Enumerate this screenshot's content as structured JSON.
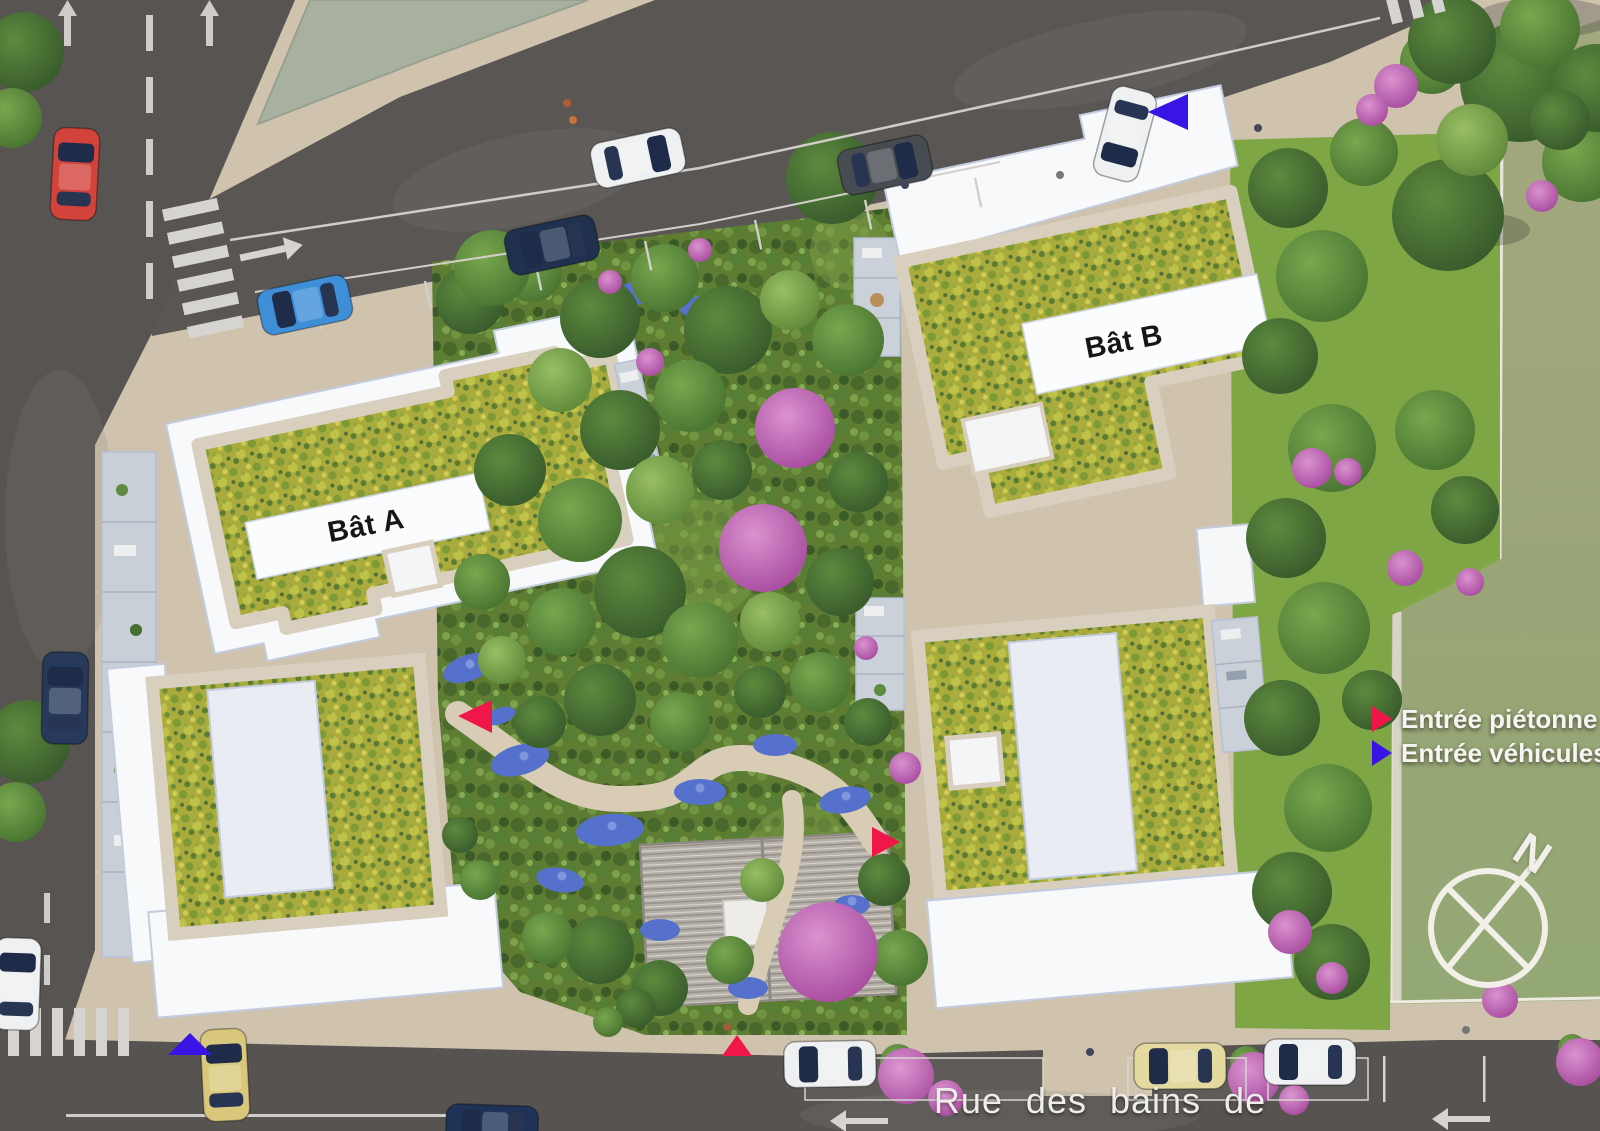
{
  "scene": {
    "type": "aerial-residential-site-plan"
  },
  "buildings": {
    "a": {
      "label": "Bât A"
    },
    "b": {
      "label": "Bât B"
    }
  },
  "legend": {
    "items": [
      {
        "label": "Entrée piétonne",
        "color": "#ef1648"
      },
      {
        "label": "Entrée véhicules",
        "color": "#3a14e4"
      }
    ]
  },
  "street": {
    "name": "Rue des bains de mer"
  },
  "compass": {
    "label": "N"
  },
  "palette": {
    "asphalt": "#595653",
    "sidewalk": "#cfc3ae",
    "roof_green": "#a9ac3c",
    "gravel": "#d9cfbf",
    "building_white": "#f8f9fb",
    "parapet_blue": "#c3cbdf",
    "lawn": "#9aa57c",
    "sage_roof": "#a8b1a0",
    "road_marking": "#d2cfca"
  }
}
